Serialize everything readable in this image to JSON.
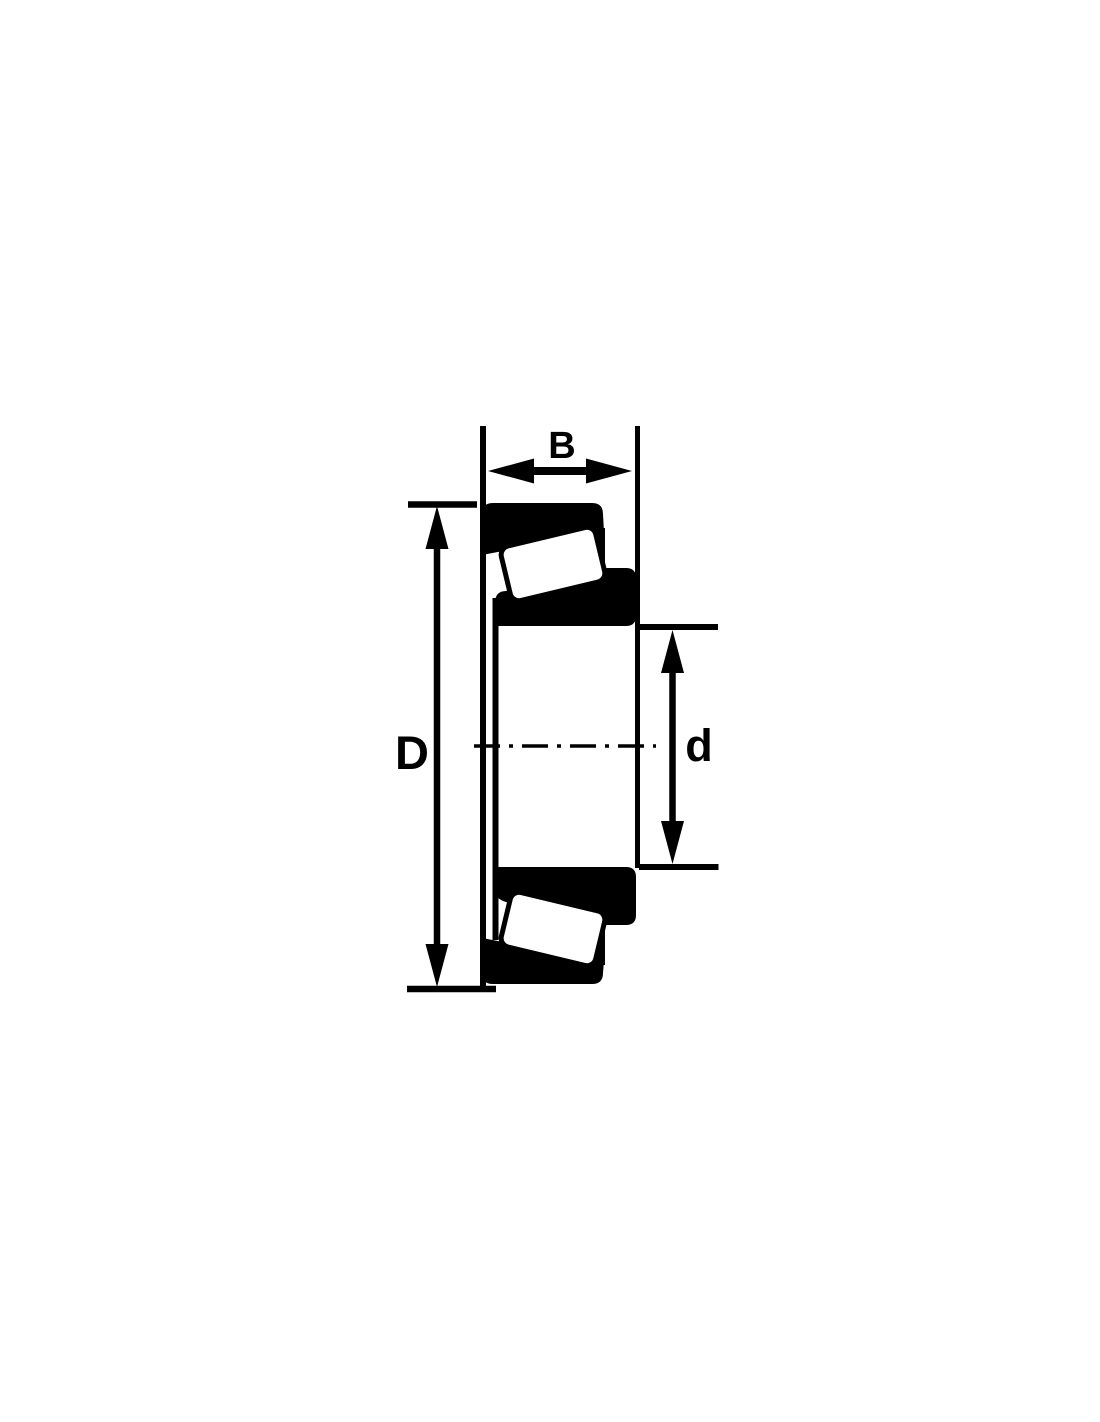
{
  "drawing": {
    "colors": {
      "ink": "#000000",
      "background": "#ffffff"
    },
    "labels": {
      "width": "B",
      "outer_diameter": "D",
      "bore_diameter": "d"
    }
  }
}
